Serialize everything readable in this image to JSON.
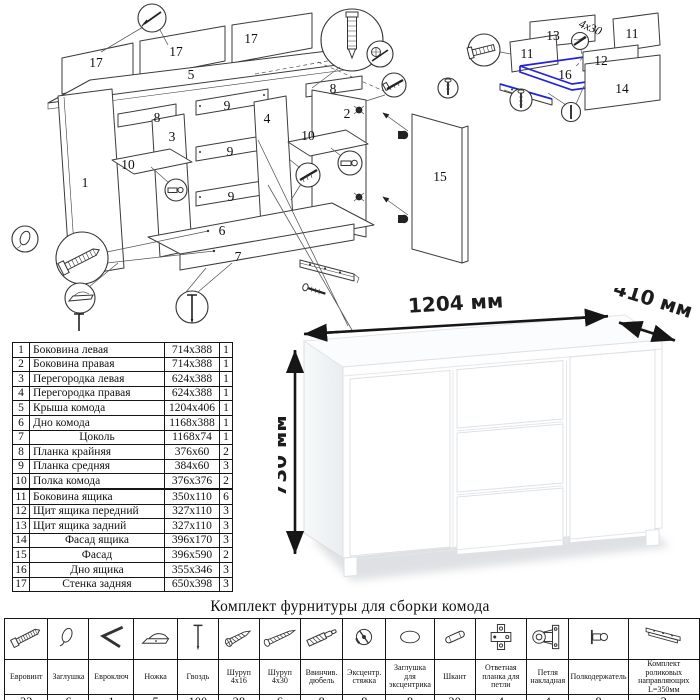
{
  "diagram": {
    "part_numbers": [
      "17",
      "17",
      "17",
      "5",
      "8",
      "3",
      "10",
      "1",
      "9",
      "9",
      "9",
      "4",
      "8",
      "2",
      "10",
      "6",
      "7",
      "15",
      "13",
      "11",
      "11",
      "12",
      "16",
      "14"
    ],
    "screw_note": "4x30"
  },
  "parts_table": {
    "rows": [
      {
        "num": "1",
        "name": "Боковина левая",
        "size": "714x388",
        "qty": "1"
      },
      {
        "num": "2",
        "name": "Боковина правая",
        "size": "714x388",
        "qty": "1"
      },
      {
        "num": "3",
        "name": "Перегородка левая",
        "size": "624x388",
        "qty": "1"
      },
      {
        "num": "4",
        "name": "Перегородка правая",
        "size": "624x388",
        "qty": "1"
      },
      {
        "num": "5",
        "name": "Крыша комода",
        "size": "1204x406",
        "qty": "1"
      },
      {
        "num": "6",
        "name": "Дно комода",
        "size": "1168x388",
        "qty": "1"
      },
      {
        "num": "7",
        "name": "Цоколь",
        "size": "1168x74",
        "qty": "1"
      },
      {
        "num": "8",
        "name": "Планка крайняя",
        "size": "376x60",
        "qty": "2"
      },
      {
        "num": "9",
        "name": "Планка средняя",
        "size": "384x60",
        "qty": "3"
      },
      {
        "num": "10",
        "name": "Полка комода",
        "size": "376x376",
        "qty": "2"
      },
      {
        "num": "11",
        "name": "Боковина ящика",
        "size": "350x110",
        "qty": "6"
      },
      {
        "num": "12",
        "name": "Щит ящика передний",
        "size": "327x110",
        "qty": "3"
      },
      {
        "num": "13",
        "name": "Щит ящика задний",
        "size": "327x110",
        "qty": "3"
      },
      {
        "num": "14",
        "name": "Фасад ящика",
        "size": "396x170",
        "qty": "3"
      },
      {
        "num": "15",
        "name": "Фасад",
        "size": "396x590",
        "qty": "2"
      },
      {
        "num": "16",
        "name": "Дно ящика",
        "size": "355x346",
        "qty": "3"
      },
      {
        "num": "17",
        "name": "Стенка задняя",
        "size": "650x398",
        "qty": "3"
      }
    ]
  },
  "dresser": {
    "width_label": "1204 мм",
    "depth_label": "410 мм",
    "height_label": "730 мм"
  },
  "hardware": {
    "title": "Комплект фурнитуры для сборки комода",
    "items": [
      {
        "name": "Евровинт",
        "qty": "22",
        "icon": "euroscrew-icon"
      },
      {
        "name": "Заглушка",
        "qty": "6",
        "icon": "plug-icon"
      },
      {
        "name": "Евроключ",
        "qty": "1",
        "icon": "hexkey-icon"
      },
      {
        "name": "Ножка",
        "qty": "5",
        "icon": "foot-icon"
      },
      {
        "name": "Гвоздь",
        "qty": "100",
        "icon": "nail-icon"
      },
      {
        "name": "Шуруп 4x16",
        "qty": "28",
        "icon": "screw-4x16-icon"
      },
      {
        "name": "Шуруп 4x30",
        "qty": "6",
        "icon": "screw-4x30-icon"
      },
      {
        "name": "Ввинчив. дюбель",
        "qty": "8",
        "icon": "dowel-icon"
      },
      {
        "name": "Эксцентр. стяжка",
        "qty": "8",
        "icon": "cam-icon"
      },
      {
        "name": "Заглушка для эксцентрика",
        "qty": "8",
        "icon": "cam-plug-icon"
      },
      {
        "name": "Шкант",
        "qty": "20",
        "icon": "shkant-icon"
      },
      {
        "name": "Ответная планка для петли",
        "qty": "4",
        "icon": "hinge-plate-icon"
      },
      {
        "name": "Петля накладная",
        "qty": "4",
        "icon": "hinge-icon"
      },
      {
        "name": "Полкодержатель",
        "qty": "8",
        "icon": "shelf-pin-icon"
      },
      {
        "name": "Комплект роликовых направляющих L=350мм",
        "qty": "3",
        "icon": "roller-guides-icon"
      }
    ]
  }
}
